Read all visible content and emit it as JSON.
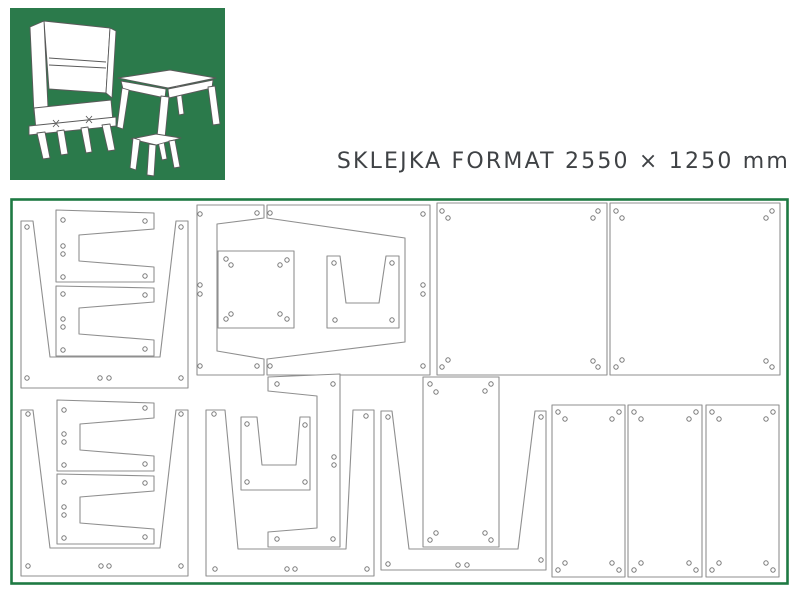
{
  "header": {
    "title": "SKLEJKA FORMAT 2550 × 1250 mm"
  },
  "colors": {
    "brand_green": "#2b7a4b",
    "sheet_border_green": "#1e7a43",
    "piece_outline_gray": "#8f8f8f",
    "title_text": "#3f4245",
    "background": "#ffffff"
  },
  "logo": {
    "furniture": [
      "writing-cabinet",
      "table",
      "stool"
    ]
  },
  "sheet": {
    "format_width_mm": 2550,
    "format_height_mm": 1250,
    "pieces": [
      {
        "name": "table-side-panel-1",
        "points": "21,221 33,221 50,357 160,357 176,221 188,221 188,388 21,388",
        "holes": [
          [
            27,
            227
          ],
          [
            181,
            227
          ],
          [
            27,
            378
          ],
          [
            100,
            378
          ],
          [
            109,
            378
          ],
          [
            181,
            378
          ]
        ]
      },
      {
        "name": "cross-beam-1",
        "points": "56,210 154,213 154,229 79,235 79,261 154,267 154,282 56,282",
        "holes": [
          [
            63,
            220
          ],
          [
            145,
            221
          ],
          [
            63,
            246
          ],
          [
            63,
            254
          ],
          [
            63,
            277
          ],
          [
            145,
            276
          ]
        ]
      },
      {
        "name": "cross-beam-2",
        "points": "56,286 154,288 154,302 79,308 79,334 154,340 154,356 56,356",
        "holes": [
          [
            63,
            294
          ],
          [
            145,
            295
          ],
          [
            63,
            319
          ],
          [
            63,
            327
          ],
          [
            63,
            350
          ],
          [
            145,
            349
          ]
        ]
      },
      {
        "name": "desk-frame-left",
        "points": "197,205 264,205 264,218 217,224 217,351 264,359 264,375 197,375",
        "holes": [
          [
            200,
            214
          ],
          [
            257,
            213
          ],
          [
            200,
            285
          ],
          [
            200,
            294
          ],
          [
            200,
            366
          ],
          [
            257,
            366
          ]
        ]
      },
      {
        "name": "desk-frame-right",
        "points": "267,205 430,205 430,375 267,375 267,359 405,342 405,238 267,218",
        "holes": [
          [
            270,
            213
          ],
          [
            423,
            214
          ],
          [
            423,
            285
          ],
          [
            423,
            294
          ],
          [
            270,
            366
          ],
          [
            423,
            366
          ]
        ]
      },
      {
        "name": "stool-top",
        "points": "218,251 294,251 294,328 218,328",
        "holes": [
          [
            226,
            259
          ],
          [
            231,
            265
          ],
          [
            287,
            260
          ],
          [
            280,
            265
          ],
          [
            231,
            314
          ],
          [
            226,
            319
          ],
          [
            280,
            314
          ],
          [
            287,
            319
          ]
        ]
      },
      {
        "name": "stool-side-1",
        "points": "327,256 340,256 346,303 379,303 386,256 399,256 399,328 327,328",
        "holes": [
          [
            334,
            263
          ],
          [
            392,
            263
          ],
          [
            335,
            320
          ],
          [
            392,
            320
          ]
        ]
      },
      {
        "name": "large-panel-1",
        "points": "437,203 607,203 607,375 437,375",
        "holes": [
          [
            442,
            211
          ],
          [
            448,
            218
          ],
          [
            598,
            211
          ],
          [
            593,
            218
          ],
          [
            448,
            360
          ],
          [
            442,
            367
          ],
          [
            593,
            361
          ],
          [
            598,
            367
          ]
        ]
      },
      {
        "name": "large-panel-2",
        "points": "610,203 780,203 780,375 610,375",
        "holes": [
          [
            616,
            211
          ],
          [
            622,
            218
          ],
          [
            772,
            211
          ],
          [
            766,
            218
          ],
          [
            622,
            360
          ],
          [
            616,
            367
          ],
          [
            766,
            361
          ],
          [
            772,
            367
          ]
        ]
      },
      {
        "name": "table-side-panel-2",
        "points": "21,410 33,410 50,548 160,548 176,410 188,410 188,576 21,576",
        "holes": [
          [
            28,
            414
          ],
          [
            181,
            414
          ],
          [
            28,
            566
          ],
          [
            101,
            566
          ],
          [
            109,
            566
          ],
          [
            181,
            566
          ]
        ]
      },
      {
        "name": "cross-beam-3",
        "points": "57,400 154,403 154,418 80,424 80,450 154,456 154,471 57,471",
        "holes": [
          [
            64,
            410
          ],
          [
            145,
            408
          ],
          [
            64,
            434
          ],
          [
            64,
            442
          ],
          [
            64,
            465
          ],
          [
            145,
            464
          ]
        ]
      },
      {
        "name": "cross-beam-4",
        "points": "57,474 154,476 154,491 80,497 80,523 154,529 154,544 57,544",
        "holes": [
          [
            64,
            482
          ],
          [
            145,
            483
          ],
          [
            64,
            507
          ],
          [
            64,
            515
          ],
          [
            64,
            538
          ],
          [
            145,
            537
          ]
        ]
      },
      {
        "name": "support-bracket",
        "points": "268,377 340,374 340,547 268,547 268,532 317,528 317,396 268,391",
        "holes": [
          [
            277,
            384
          ],
          [
            333,
            384
          ],
          [
            334,
            457
          ],
          [
            334,
            465
          ],
          [
            277,
            539
          ],
          [
            333,
            539
          ]
        ]
      },
      {
        "name": "stool-side-2",
        "points": "241,417 257,417 262,465 296,465 300,417 310,417 310,490 241,490",
        "holes": [
          [
            247,
            424
          ],
          [
            305,
            425
          ],
          [
            247,
            482
          ],
          [
            305,
            482
          ]
        ]
      },
      {
        "name": "table-side-panel-3",
        "points": "206,410 225,410 238,549 346,549 353,410 374,410 374,576 206,576",
        "holes": [
          [
            214,
            414
          ],
          [
            366,
            416
          ],
          [
            215,
            569
          ],
          [
            287,
            569
          ],
          [
            295,
            569
          ],
          [
            367,
            569
          ]
        ]
      },
      {
        "name": "table-side-panel-4",
        "points": "381,411 392,411 409,549 518,549 535,411 546,411 546,570 381,570",
        "holes": [
          [
            388,
            417
          ],
          [
            541,
            417
          ],
          [
            388,
            564
          ],
          [
            458,
            565
          ],
          [
            467,
            565
          ],
          [
            541,
            560
          ]
        ]
      },
      {
        "name": "shelf-panel",
        "points": "423,377 499,377 499,547 423,547",
        "holes": [
          [
            430,
            384
          ],
          [
            436,
            392
          ],
          [
            491,
            384
          ],
          [
            485,
            391
          ],
          [
            436,
            533
          ],
          [
            430,
            540
          ],
          [
            485,
            533
          ],
          [
            491,
            540
          ]
        ]
      },
      {
        "name": "door-panel-1",
        "points": "552,405 625,405 625,577 552,577",
        "holes": [
          [
            558,
            412
          ],
          [
            565,
            419
          ],
          [
            619,
            412
          ],
          [
            612,
            419
          ],
          [
            565,
            563
          ],
          [
            558,
            570
          ],
          [
            612,
            563
          ],
          [
            619,
            570
          ]
        ]
      },
      {
        "name": "door-panel-2",
        "points": "628,405 702,405 702,577 628,577",
        "holes": [
          [
            634,
            412
          ],
          [
            641,
            419
          ],
          [
            696,
            412
          ],
          [
            689,
            419
          ],
          [
            641,
            563
          ],
          [
            634,
            570
          ],
          [
            689,
            563
          ],
          [
            696,
            570
          ]
        ]
      },
      {
        "name": "door-panel-3",
        "points": "706,405 779,405 779,577 706,577",
        "holes": [
          [
            712,
            412
          ],
          [
            719,
            419
          ],
          [
            773,
            412
          ],
          [
            766,
            419
          ],
          [
            719,
            563
          ],
          [
            712,
            570
          ],
          [
            766,
            563
          ],
          [
            773,
            570
          ]
        ]
      }
    ]
  }
}
